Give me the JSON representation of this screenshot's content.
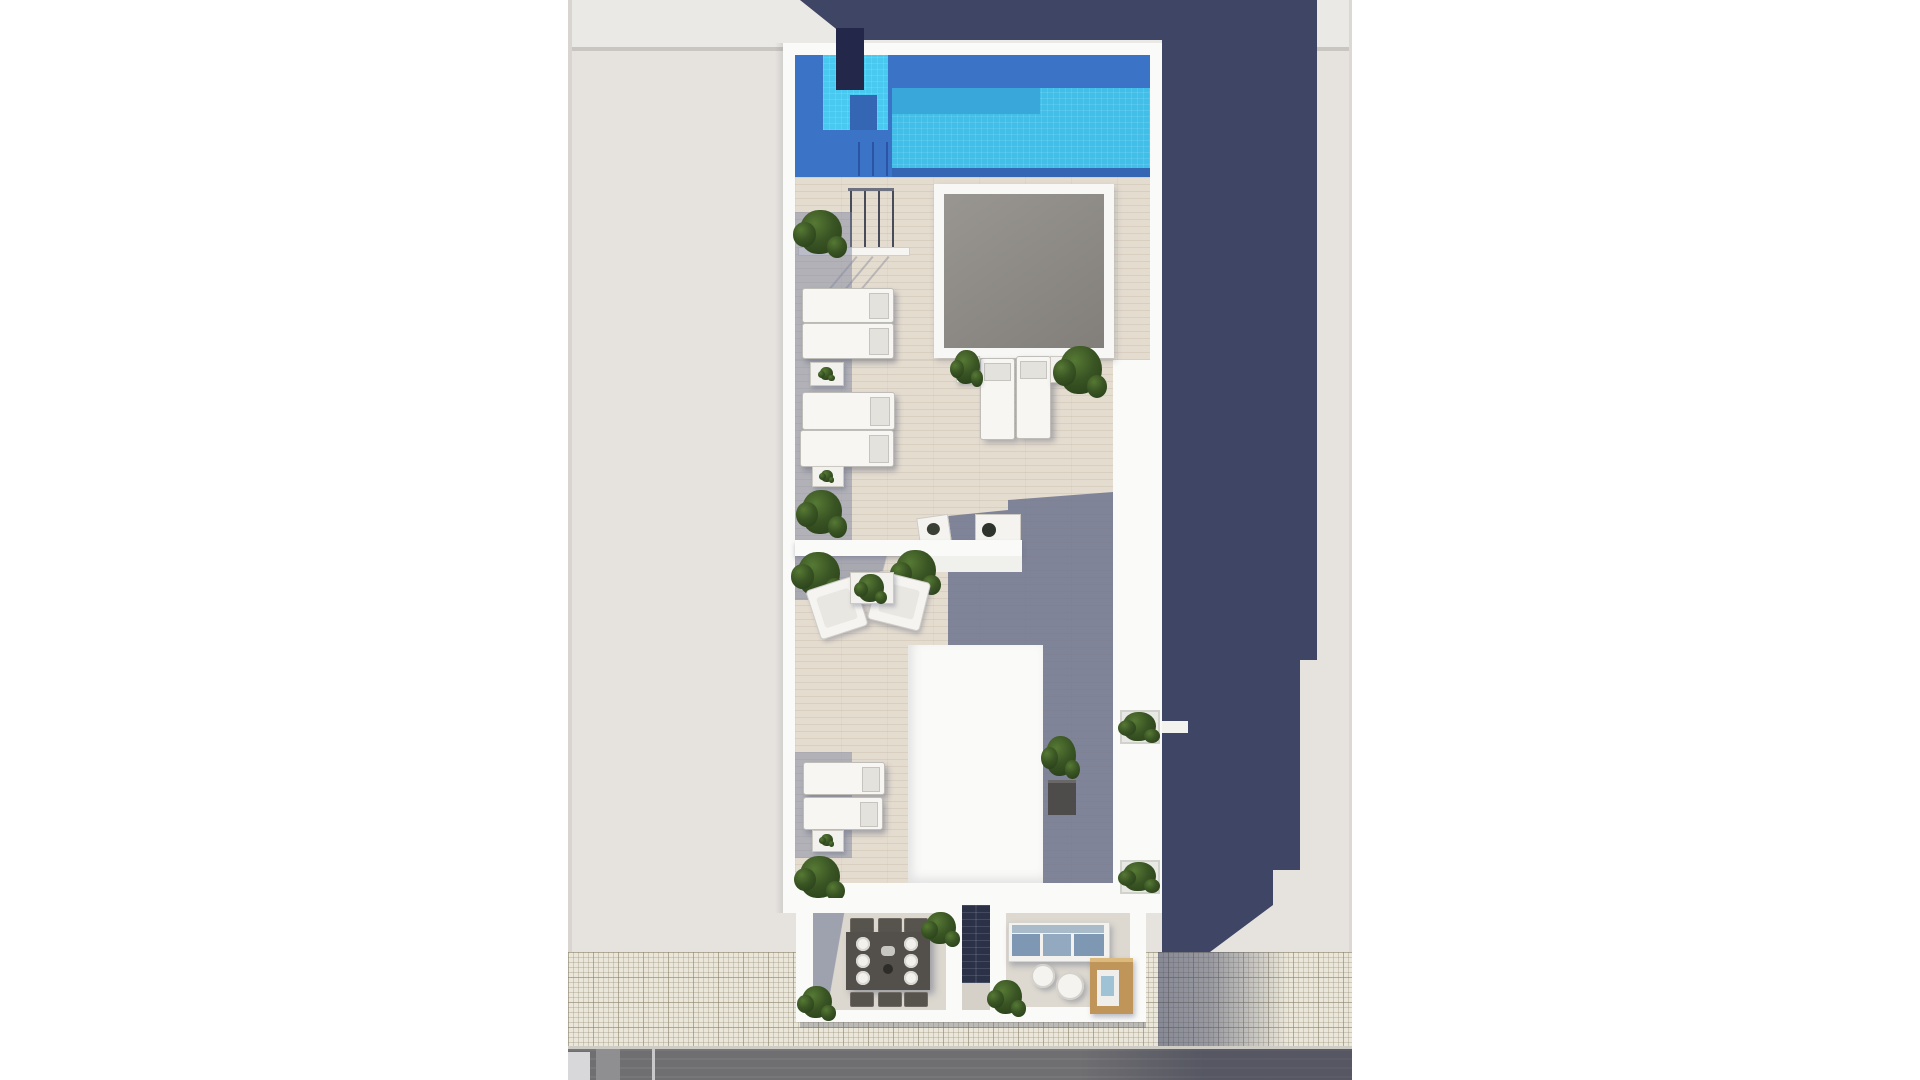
{
  "meta": {
    "type": "architectural-render",
    "view": "aerial-top-down",
    "description": "Aerial 3D render of a narrow rooftop solarium with swimming pool, wooden sun deck, skylight, stair bulkhead and two street-level terraces; long navy building shadow cast to the right; sidewalk and asphalt road at the bottom."
  },
  "palette": {
    "page": "#ffffff",
    "ground": "#e6e3df",
    "ground_top": "#ebe9e5",
    "ground_line": "#c9c5c0",
    "building_shadow": "#3f4665",
    "wall_white": "#fafaf8",
    "deck": "#e4dccf",
    "deck_shadow": "#7d8499",
    "pool_water": "#41bfe9",
    "pool_shadow": "#3b74c6",
    "pool_dark": "#3566b4",
    "pool_mid": "#3aa7da",
    "pool_step": "#4ac9f0",
    "pool_pillar": "#23284a",
    "skylight": "#8f8c87",
    "lounger": "#f7f6f3",
    "mat_shadow": "#9aa1b5",
    "plant_green": "#3a5524",
    "dining_table": "#53504b",
    "cushion_blue": "#7e97b2",
    "wood_tan": "#c0955a",
    "door_dark": "#2b3147",
    "sidewalk": "#eae6d9",
    "curb": "#cfccc5",
    "road": "#6f6e71",
    "terrace_floor": "#dcd8cf",
    "lounge_floor": "#ddd9d0"
  },
  "objects": {
    "swimming_pool": 1,
    "pool_ladder_rails": 3,
    "pool_pillar": 1,
    "stair_railing_posts": 4,
    "skylight": 1,
    "sun_loungers": 8,
    "side_tables": 5,
    "armchairs": 2,
    "coffee_table": 1,
    "bistro_chair": 1,
    "bistro_table": 1,
    "stair_bulkhead": 1,
    "dining_table": 1,
    "dining_plates": 6,
    "dining_chairs": 6,
    "sofa": 1,
    "sofa_cushions": 3,
    "round_tables": 2,
    "outdoor_kitchen": 1,
    "barbecue": 1,
    "entrance_door": 1,
    "wall_planters": 2,
    "plants": 14,
    "road_markings": 3
  }
}
